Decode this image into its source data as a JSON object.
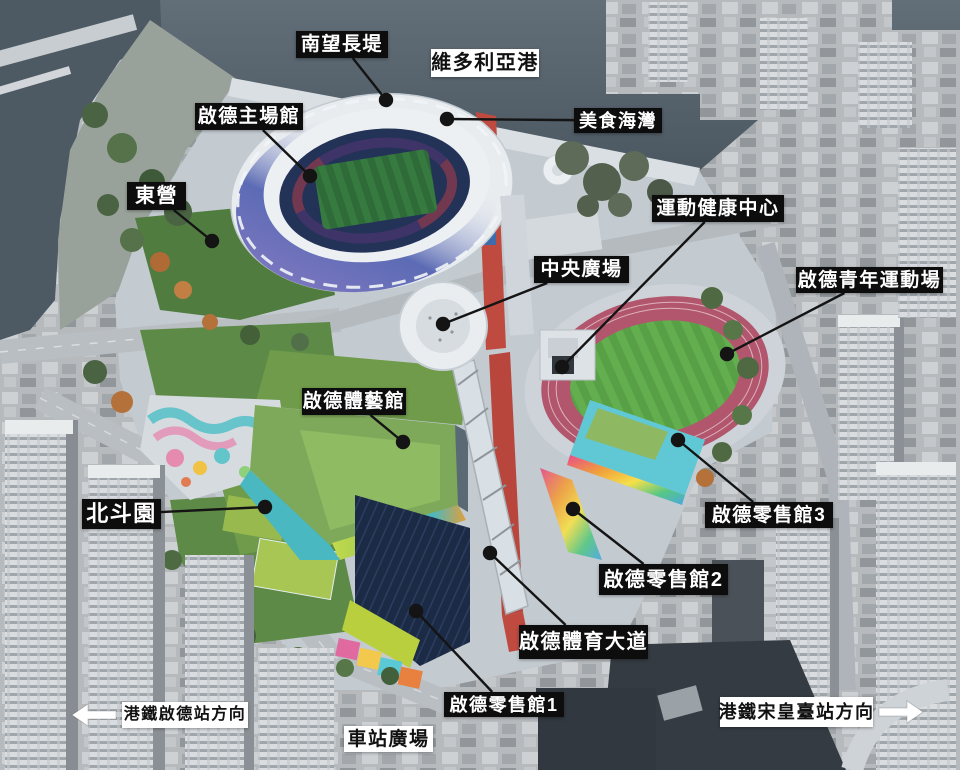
{
  "map": {
    "description_labels_language": "zh-Hant",
    "labels": [
      {
        "id": "south-breakwater",
        "text": "南望長堤",
        "style": "dark",
        "box": {
          "x": 296,
          "y": 31,
          "w": 92,
          "h": 27
        },
        "dot": {
          "x": 386,
          "y": 100
        }
      },
      {
        "id": "victoria-harbour",
        "text": "維多利亞港",
        "style": "light",
        "box": {
          "x": 431,
          "y": 49,
          "w": 108,
          "h": 28
        }
      },
      {
        "id": "kai-tak-main-stadium",
        "text": "啟德主場館",
        "style": "dark",
        "box": {
          "x": 195,
          "y": 103,
          "w": 108,
          "h": 27
        },
        "dot": {
          "x": 310,
          "y": 176
        }
      },
      {
        "id": "food-bay",
        "text": "美食海灣",
        "style": "dark",
        "box": {
          "x": 574,
          "y": 108,
          "w": 88,
          "h": 25
        },
        "dot": {
          "x": 447,
          "y": 119
        }
      },
      {
        "id": "east-lawn",
        "text": "東營",
        "style": "dark",
        "box": {
          "x": 127,
          "y": 182,
          "w": 59,
          "h": 28
        },
        "dot": {
          "x": 212,
          "y": 241
        }
      },
      {
        "id": "sports-health-centre",
        "text": "運動健康中心",
        "style": "dark",
        "box": {
          "x": 652,
          "y": 195,
          "w": 132,
          "h": 27
        },
        "dot": {
          "x": 562,
          "y": 367
        }
      },
      {
        "id": "central-plaza",
        "text": "中央廣場",
        "style": "dark",
        "box": {
          "x": 534,
          "y": 256,
          "w": 95,
          "h": 27
        },
        "dot": {
          "x": 443,
          "y": 324
        }
      },
      {
        "id": "youth-sports-ground",
        "text": "啟德青年運動場",
        "style": "dark",
        "box": {
          "x": 796,
          "y": 267,
          "w": 147,
          "h": 26
        },
        "dot": {
          "x": 727,
          "y": 354
        }
      },
      {
        "id": "kai-tak-arena",
        "text": "啟德體藝館",
        "style": "dark",
        "box": {
          "x": 302,
          "y": 388,
          "w": 104,
          "h": 27
        },
        "dot": {
          "x": 403,
          "y": 442
        }
      },
      {
        "id": "dipper-garden",
        "text": "北斗園",
        "style": "dark",
        "box": {
          "x": 82,
          "y": 499,
          "w": 79,
          "h": 30
        },
        "dot": {
          "x": 265,
          "y": 507
        }
      },
      {
        "id": "retail-hall-3",
        "text": "啟德零售館3",
        "style": "dark",
        "box": {
          "x": 705,
          "y": 502,
          "w": 128,
          "h": 26
        },
        "dot": {
          "x": 678,
          "y": 440
        }
      },
      {
        "id": "retail-hall-2",
        "text": "啟德零售館2",
        "style": "dark",
        "box": {
          "x": 599,
          "y": 564,
          "w": 129,
          "h": 31
        },
        "dot": {
          "x": 573,
          "y": 509
        }
      },
      {
        "id": "sports-avenue",
        "text": "啟德體育大道",
        "style": "dark",
        "box": {
          "x": 519,
          "y": 625,
          "w": 129,
          "h": 34
        },
        "dot": {
          "x": 490,
          "y": 553
        }
      },
      {
        "id": "retail-hall-1",
        "text": "啟德零售館1",
        "style": "dark",
        "box": {
          "x": 444,
          "y": 692,
          "w": 120,
          "h": 25
        },
        "dot": {
          "x": 416,
          "y": 611
        }
      },
      {
        "id": "mtr-kai-tak-station-direction",
        "text": "港鐵啟德站方向",
        "style": "light",
        "box": {
          "x": 122,
          "y": 702,
          "w": 126,
          "h": 26
        },
        "arrow": "left"
      },
      {
        "id": "station-square",
        "text": "車站廣場",
        "style": "light",
        "box": {
          "x": 344,
          "y": 726,
          "w": 89,
          "h": 26
        }
      },
      {
        "id": "mtr-sung-wong-toi-station-direction",
        "text": "港鐵宋皇臺站方向",
        "style": "light",
        "box": {
          "x": 720,
          "y": 697,
          "w": 153,
          "h": 30
        },
        "arrow": "right"
      }
    ],
    "colors": {
      "label_dark_bg": "#0d0d0d",
      "label_dark_text": "#ffffff",
      "label_light_bg": "#ffffff",
      "label_light_text": "#111111",
      "connector": "#141414",
      "arrow_fill": "#ffffff"
    }
  }
}
